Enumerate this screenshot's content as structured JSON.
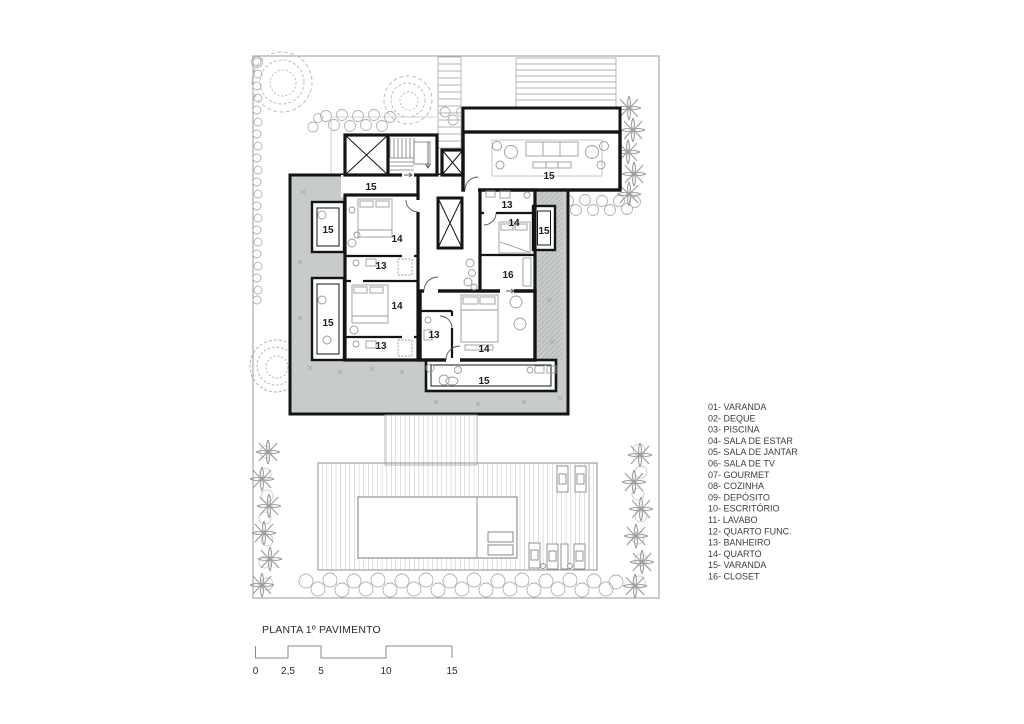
{
  "drawing": {
    "title": "PLANTA 1º PAVIMENTO",
    "type": "architectural floor plan, first floor"
  },
  "legend": {
    "items": [
      "01- VARANDA",
      "02- DEQUE",
      "03- PISCINA",
      "04- SALA DE ESTAR",
      "05- SALA DE JANTAR",
      "06- SALA DE TV",
      "07- GOURMET",
      "08- COZINHA",
      "09- DEPÓSITO",
      "10- ESCRITÓRIO",
      "11- LAVABO",
      "12- QUARTO FUNC.",
      "13- BANHEIRO",
      "14- QUARTO",
      "15- VARANDA",
      "16- CLOSET"
    ]
  },
  "scale_bar": {
    "labels": [
      "0",
      "2,5",
      "5",
      "10",
      "15"
    ]
  },
  "room_labels": [
    {
      "text": "15"
    },
    {
      "text": "15"
    },
    {
      "text": "13"
    },
    {
      "text": "14"
    },
    {
      "text": "15"
    },
    {
      "text": "15"
    },
    {
      "text": "14"
    },
    {
      "text": "13"
    },
    {
      "text": "16"
    },
    {
      "text": "14"
    },
    {
      "text": "15"
    },
    {
      "text": "13"
    },
    {
      "text": "13"
    },
    {
      "text": "14"
    },
    {
      "text": "15"
    }
  ],
  "colors": {
    "wall": "#141414",
    "deck_fill": "#c7ccc8",
    "vegetation": "#a6a6a6",
    "thin_line": "#999999",
    "stair_line": "#b3b3b3"
  }
}
